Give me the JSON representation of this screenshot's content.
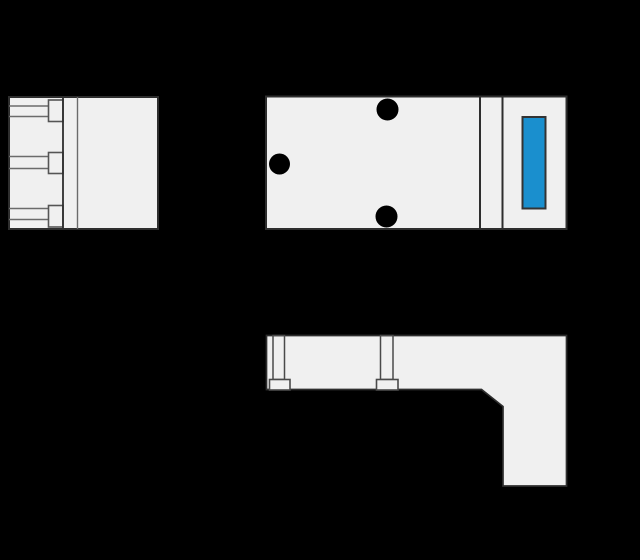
{
  "canvas": {
    "width": 640,
    "height": 560,
    "background": "#000000"
  },
  "palette": {
    "part_fill": "#f0f0f0",
    "outline": "#2e2e2e",
    "inner_line": "#6b6b6b",
    "tip_stroke": "#555555",
    "screw_line": "#4a4a4a",
    "hole_fill": "#000000",
    "indicator_fill": "#1a8fce",
    "indicator_stroke": "#333333"
  },
  "views": [
    {
      "id": "side-view-left",
      "shapes": [
        {
          "name": "side-view-body",
          "type": "rect",
          "x": 9,
          "y": 97,
          "w": 149,
          "h": 132,
          "fill": "part_fill",
          "stroke": "outline",
          "sw": 2
        },
        {
          "name": "terminal-slot-1-top-line",
          "type": "line",
          "x1": 9,
          "y1": 106,
          "x2": 48.5,
          "y2": 106,
          "stroke": "inner_line",
          "sw": 1.4
        },
        {
          "name": "terminal-slot-1-bottom-line",
          "type": "line",
          "x1": 9,
          "y1": 116.5,
          "x2": 48.5,
          "y2": 116.5,
          "stroke": "inner_line",
          "sw": 1.6
        },
        {
          "name": "terminal-slot-2-top-line",
          "type": "line",
          "x1": 9,
          "y1": 156.5,
          "x2": 48.5,
          "y2": 156.5,
          "stroke": "inner_line",
          "sw": 1.4
        },
        {
          "name": "terminal-slot-2-bottom-line",
          "type": "line",
          "x1": 9,
          "y1": 168.5,
          "x2": 48.5,
          "y2": 168.5,
          "stroke": "inner_line",
          "sw": 1.6
        },
        {
          "name": "terminal-slot-3-top-line",
          "type": "line",
          "x1": 9,
          "y1": 208.5,
          "x2": 48.5,
          "y2": 208.5,
          "stroke": "inner_line",
          "sw": 1.4
        },
        {
          "name": "terminal-slot-3-bottom-line",
          "type": "line",
          "x1": 9,
          "y1": 219.5,
          "x2": 48.5,
          "y2": 219.5,
          "stroke": "inner_line",
          "sw": 1.6
        },
        {
          "name": "terminal-tip-1",
          "type": "rect",
          "x": 48.5,
          "y": 100,
          "w": 14.5,
          "h": 21.5,
          "fill": "part_fill",
          "stroke": "tip_stroke",
          "sw": 1.6
        },
        {
          "name": "terminal-tip-2",
          "type": "rect",
          "x": 48.5,
          "y": 152.5,
          "w": 14.5,
          "h": 21,
          "fill": "part_fill",
          "stroke": "tip_stroke",
          "sw": 1.6
        },
        {
          "name": "terminal-tip-3",
          "type": "rect",
          "x": 48.5,
          "y": 205.5,
          "w": 14.5,
          "h": 21.5,
          "fill": "part_fill",
          "stroke": "tip_stroke",
          "sw": 1.6
        },
        {
          "name": "flange-divider-left",
          "type": "line",
          "x1": 63,
          "y1": 97,
          "x2": 63,
          "y2": 229,
          "stroke": "outline",
          "sw": 1.8
        },
        {
          "name": "flange-divider-right",
          "type": "line",
          "x1": 77.5,
          "y1": 97,
          "x2": 77.5,
          "y2": 229,
          "stroke": "inner_line",
          "sw": 1.4
        }
      ]
    },
    {
      "id": "top-view",
      "shapes": [
        {
          "name": "top-view-main-body",
          "type": "rect",
          "x": 266,
          "y": 96.5,
          "w": 214,
          "h": 132.5,
          "fill": "part_fill",
          "stroke": "outline",
          "sw": 2
        },
        {
          "name": "top-view-flange-strip",
          "type": "rect",
          "x": 480,
          "y": 96.5,
          "w": 22.5,
          "h": 132.5,
          "fill": "part_fill",
          "stroke": "outline",
          "sw": 2
        },
        {
          "name": "top-view-end-cap",
          "type": "rect",
          "x": 502.5,
          "y": 96.5,
          "w": 64,
          "h": 132.5,
          "fill": "part_fill",
          "stroke": "outline",
          "sw": 2
        },
        {
          "name": "mounting-hole-top",
          "type": "circle",
          "cx": 387.5,
          "cy": 109.5,
          "r": 11,
          "fill": "hole_fill"
        },
        {
          "name": "mounting-hole-left",
          "type": "circle",
          "cx": 279.5,
          "cy": 164,
          "r": 10.5,
          "fill": "hole_fill"
        },
        {
          "name": "mounting-hole-bottom",
          "type": "circle",
          "cx": 386.5,
          "cy": 216.5,
          "r": 11,
          "fill": "hole_fill"
        },
        {
          "name": "blue-indicator-window",
          "type": "rect",
          "x": 522.5,
          "y": 117,
          "w": 23,
          "h": 91.5,
          "fill": "indicator_fill",
          "stroke": "indicator_stroke",
          "sw": 2
        }
      ]
    },
    {
      "id": "front-view",
      "shapes": [
        {
          "name": "front-view-l-body",
          "type": "polygon",
          "points": [
            [
              266.5,
              335.5
            ],
            [
              566.5,
              335.5
            ],
            [
              566.5,
              486
            ],
            [
              503,
              486
            ],
            [
              503,
              406.5
            ],
            [
              481.5,
              389.5
            ],
            [
              266.5,
              389.5
            ]
          ],
          "fill": "part_fill",
          "stroke": "outline",
          "sw": 1.7
        },
        {
          "name": "screw-shaft-1",
          "type": "rect",
          "x": 273,
          "y": 335.5,
          "w": 11.5,
          "h": 44,
          "fill": "none",
          "stroke": "screw_line",
          "sw": 1.5
        },
        {
          "name": "screw-shaft-2",
          "type": "rect",
          "x": 380.5,
          "y": 335.5,
          "w": 12.5,
          "h": 44,
          "fill": "none",
          "stroke": "screw_line",
          "sw": 1.5
        },
        {
          "name": "screw-foot-1",
          "type": "rect",
          "x": 269.5,
          "y": 379.5,
          "w": 20.5,
          "h": 10.5,
          "fill": "part_fill",
          "stroke": "screw_line",
          "sw": 1.6
        },
        {
          "name": "screw-foot-2",
          "type": "rect",
          "x": 376.5,
          "y": 379.5,
          "w": 21.5,
          "h": 10.5,
          "fill": "part_fill",
          "stroke": "screw_line",
          "sw": 1.6
        }
      ]
    }
  ]
}
